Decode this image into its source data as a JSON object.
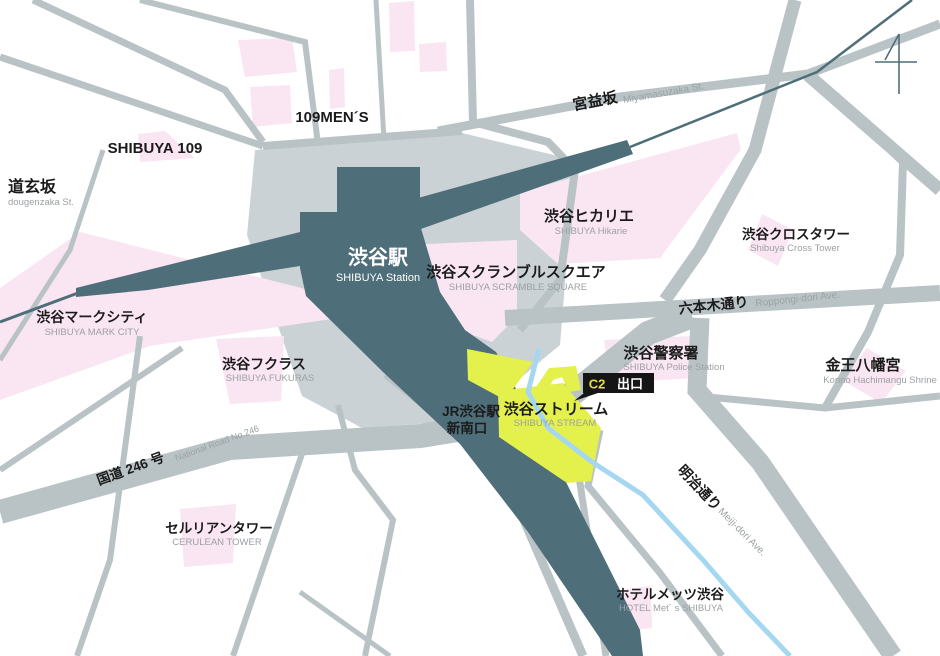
{
  "palette": {
    "road": "#b9c3c6",
    "station_block": "#cbd2d5",
    "station_fill": "#4e6e79",
    "building_pink": "#fae5f3",
    "highlight_yellow": "#e4f04b",
    "river_blue": "#a5d8f0",
    "text_black": "#1b1b1b",
    "text_gray": "#9ba1a3",
    "badge_bg": "#151515",
    "badge_yellow": "#e6de42"
  },
  "station": {
    "jp": "渋谷駅",
    "en": "SHIBUYA Station"
  },
  "jr_exit": {
    "line1": "JR渋谷駅",
    "line2": "新南口"
  },
  "exit_badge": {
    "code": "C2",
    "label": "出口"
  },
  "landmarks": {
    "shibuya109": {
      "jp": "SHIBUYA 109"
    },
    "men109": {
      "jp": "109MEN´S"
    },
    "markcity": {
      "jp": "渋谷マークシティ",
      "en": "SHIBUYA MARK CITY"
    },
    "scramble": {
      "jp": "渋谷スクランブルスクエア",
      "en": "SHIBUYA SCRAMBLE SQUARE"
    },
    "hikarie": {
      "jp": "渋谷ヒカリエ",
      "en": "SHIBUYA Hikarie"
    },
    "crosstower": {
      "jp": "渋谷クロスタワー",
      "en": "Shibuya Cross Tower"
    },
    "fukuras": {
      "jp": "渋谷フクラス",
      "en": "SHIBUYA FUKURAS"
    },
    "police": {
      "jp": "渋谷警察署",
      "en": "SHIBUYA Police Station"
    },
    "shrine": {
      "jp": "金王八幡宮",
      "en": "Konno Hachimangu Shrine"
    },
    "stream": {
      "jp": "渋谷ストリーム",
      "en": "SHIBUYA STREAM"
    },
    "cerulean": {
      "jp": "セルリアンタワー",
      "en": "CERULEAN TOWER"
    },
    "hotelmets": {
      "jp": "ホテルメッツ渋谷",
      "en": "HOTEL Met´ s SHIBUYA"
    }
  },
  "streets": {
    "dougenzaka": {
      "jp": "道玄坂",
      "en": "dougenzaka St."
    },
    "miyamasuzaka": {
      "jp": "宮益坂",
      "en": "Miyamasuzaka St."
    },
    "roppongi": {
      "jp": "六本木通り",
      "en": "Roppongi-dori Ave."
    },
    "route246": {
      "jp": "国道 246 号",
      "en": "National Road No.246"
    },
    "meiji": {
      "jp": "明治通り",
      "en": "Meiji-dori Ave."
    }
  }
}
